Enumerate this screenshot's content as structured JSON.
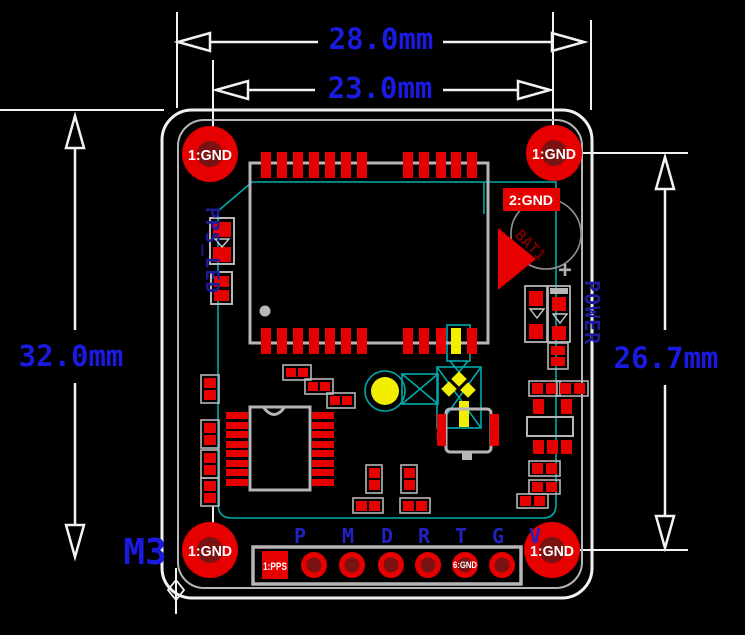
{
  "window": {
    "background": "#000000",
    "type": "pcb-dimension-drawing"
  },
  "colors": {
    "dimension_text_blue": "#1a1ae0",
    "silkscreen_text_navy": "#1c1c9a",
    "pin_label_blue": "#2222c0",
    "pad_red": "#e60000",
    "pad_dark_red": "#7a1212",
    "courtyard_teal": "#00aaaa",
    "outline_gray": "#b6b6b6",
    "highlight_yellow": "#f2ee00",
    "line_white": "#f2f2f2"
  },
  "dimensions": {
    "board_width": "28.0mm",
    "hole_span_width": "23.0mm",
    "board_height": "32.0mm",
    "hole_span_height": "26.7mm"
  },
  "labels": {
    "mounting_hole": "1:GND",
    "gnd2": "2:GND",
    "pps_led": "PPS_LED",
    "power": "POWER",
    "m3": "M3",
    "battery_designator": "BAT1",
    "battery_plus": "+",
    "pad1_pps": "1:PPS",
    "pad6_gnd": "6:GND"
  },
  "connector": {
    "pins": [
      "P",
      "M",
      "D",
      "R",
      "T",
      "G",
      "V"
    ]
  }
}
